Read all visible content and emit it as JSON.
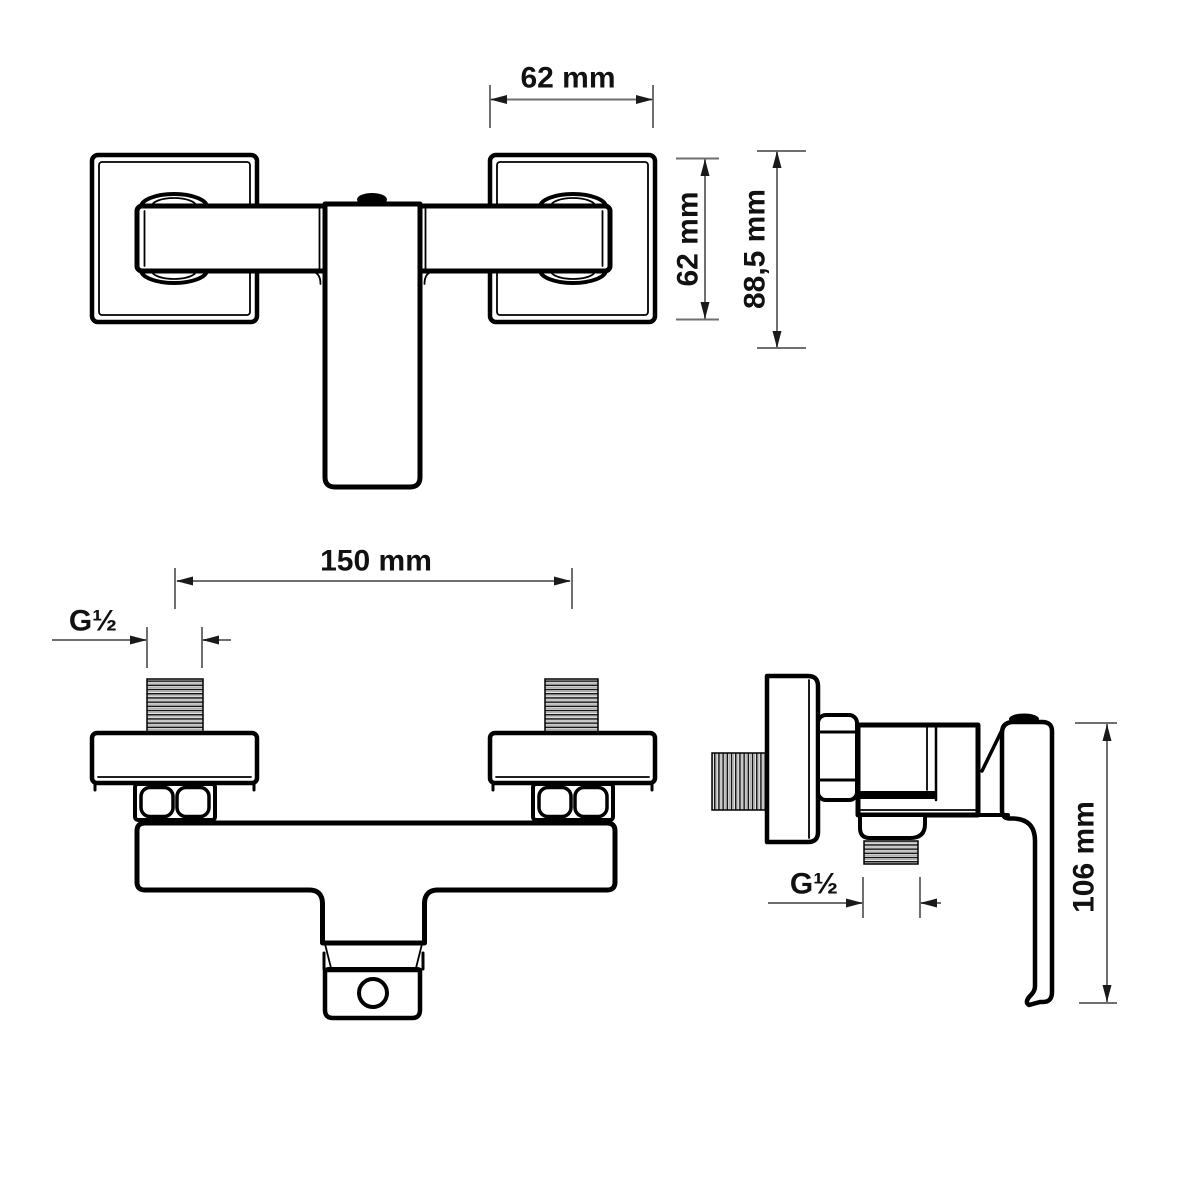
{
  "diagram": {
    "type": "technical-dimension-drawing",
    "subject": "wall-mounted single-lever shower mixer tap, three orthographic views",
    "background_color": "#ffffff",
    "outline_color": "#000000",
    "dimension_line_color": "#6f6f6f",
    "label_color": "#111111",
    "labels": {
      "top_width": "62 mm",
      "plate_height": "62 mm",
      "overall_depth": "88,5 mm",
      "hole_distance": "150 mm",
      "inlet_thread": "G½",
      "outlet_thread": "G½",
      "overall_height": "106 mm"
    },
    "views": {
      "top": {
        "title": "top view",
        "dimensions": [
          {
            "label": "62 mm",
            "axis": "horizontal",
            "measures": "wall plate width"
          },
          {
            "label": "62 mm",
            "axis": "vertical",
            "measures": "wall plate height"
          },
          {
            "label": "88,5 mm",
            "axis": "vertical",
            "measures": "overall projection depth"
          }
        ]
      },
      "front": {
        "title": "front view",
        "dimensions": [
          {
            "label": "150 mm",
            "axis": "horizontal",
            "measures": "distance between inlet connector centres"
          },
          {
            "label": "G½",
            "axis": "horizontal",
            "measures": "inlet thread size"
          }
        ]
      },
      "side": {
        "title": "side view",
        "dimensions": [
          {
            "label": "G½",
            "axis": "horizontal",
            "measures": "bottom outlet thread size"
          },
          {
            "label": "106 mm",
            "axis": "vertical",
            "measures": "overall body height"
          }
        ]
      }
    }
  }
}
